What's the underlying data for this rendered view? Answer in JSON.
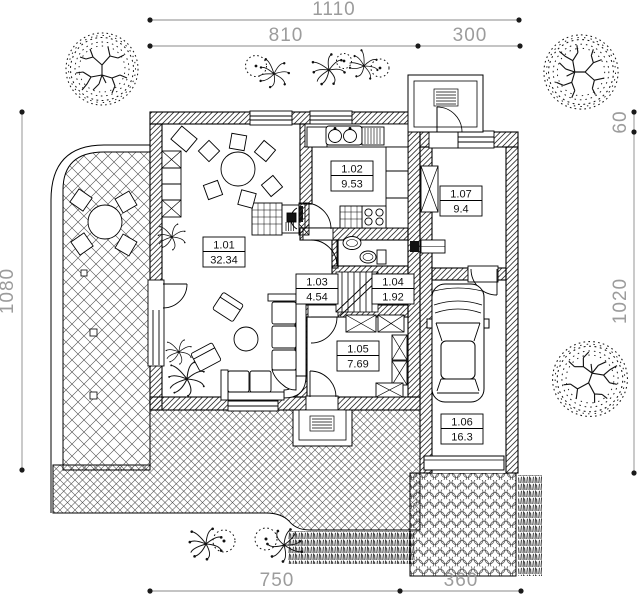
{
  "drawing": {
    "kind": "house ground-floor architectural plan with site landscaping",
    "colors": {
      "line": "#1a1a1a",
      "dimension_text": "#9c9c9c",
      "background": "#ffffff"
    },
    "dims": {
      "top_total": "1110",
      "top_left": "810",
      "top_right": "300",
      "left": "1080",
      "right_top": "60",
      "right_bottom": "1020",
      "bottom_left": "750",
      "bottom_right": "360"
    },
    "rooms": [
      {
        "number": "1.01",
        "area": "32.34"
      },
      {
        "number": "1.02",
        "area": "9.53"
      },
      {
        "number": "1.03",
        "area": "4.54"
      },
      {
        "number": "1.04",
        "area": "1.92"
      },
      {
        "number": "1.05",
        "area": "7.69"
      },
      {
        "number": "1.06",
        "area": "16.3"
      },
      {
        "number": "1.07",
        "area": "9.4"
      }
    ],
    "symbols": [
      "tree",
      "shrub",
      "potted-plant",
      "car",
      "grass",
      "hex-paving",
      "crosshatch-terrace",
      "fireplace",
      "stairs",
      "sofa",
      "dining-table",
      "kitchen-sink",
      "stove",
      "toilet",
      "wash-basin",
      "wardrobe",
      "doormat",
      "garage-door"
    ]
  }
}
